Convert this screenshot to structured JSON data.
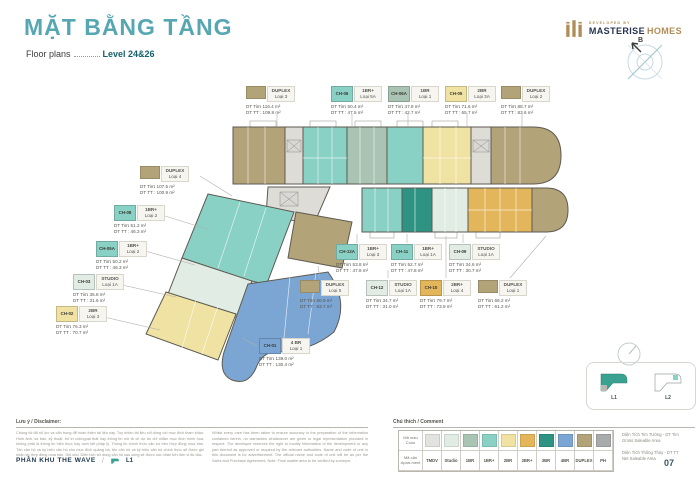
{
  "page": {
    "title_vn": "MẶT BẰNG TẦNG",
    "title_en": "Floor plans",
    "level": "Level 24&26",
    "page_number": "07"
  },
  "brand": {
    "developed_by": "DEVELOPED BY",
    "name_primary": "MASTERISE",
    "name_secondary": "HOMES",
    "compass_label": "B"
  },
  "area_labels": {
    "tim": "DT Tim",
    "tt": "DT TT",
    "unit": "m²"
  },
  "palette": {
    "tmdv": "#e2e2df",
    "studio": "#e0ece4",
    "br1": "#a9c4b2",
    "br1p": "#8ad1c5",
    "br2": "#f0e2a2",
    "br2p": "#e4b65b",
    "br3": "#2f9383",
    "br4": "#7ba6d4",
    "duplex": "#b2a478",
    "ph": "#a8abab"
  },
  "units": [
    {
      "code": "",
      "type": "DUPLEX",
      "variant": "Loại 3",
      "dt_tim": "116.4",
      "dt_tt": "109.8",
      "color": "duplex",
      "x": 246,
      "y": 86
    },
    {
      "code": "CH-06",
      "type": "1BR+",
      "variant": "Loại 5A",
      "dt_tim": "50.4",
      "dt_tt": "47.5",
      "color": "br1p",
      "x": 331,
      "y": 86
    },
    {
      "code": "CH-06A",
      "type": "1BR",
      "variant": "Loại 1",
      "dt_tim": "47.8",
      "dt_tt": "42.7",
      "color": "br1",
      "x": 388,
      "y": 86
    },
    {
      "code": "CH-05",
      "type": "2BR",
      "variant": "Loại 3A",
      "dt_tim": "71.6",
      "dt_tt": "65.7",
      "color": "br2",
      "x": 445,
      "y": 86
    },
    {
      "code": "",
      "type": "DUPLEX",
      "variant": "Loại 2",
      "dt_tim": "88.7",
      "dt_tt": "83.6",
      "color": "duplex",
      "x": 501,
      "y": 86
    },
    {
      "code": "",
      "type": "DUPLEX",
      "variant": "Loại 4",
      "dt_tim": "107.5",
      "dt_tt": "100.9",
      "color": "duplex",
      "x": 140,
      "y": 166
    },
    {
      "code": "CH-08",
      "type": "1BR+",
      "variant": "Loại 2",
      "dt_tim": "51.2",
      "dt_tt": "46.3",
      "color": "br1p",
      "x": 114,
      "y": 205
    },
    {
      "code": "CH-05A",
      "type": "1BR+",
      "variant": "Loại 2",
      "dt_tim": "50.2",
      "dt_tt": "46.3",
      "color": "br1p",
      "x": 96,
      "y": 241
    },
    {
      "code": "CH-03",
      "type": "STUDIO",
      "variant": "Loại 1A",
      "dt_tim": "35.8",
      "dt_tt": "31.6",
      "color": "studio",
      "x": 73,
      "y": 274
    },
    {
      "code": "CH-02",
      "type": "2BR",
      "variant": "Loại 3",
      "dt_tim": "76.3",
      "dt_tt": "70.7",
      "color": "br2",
      "x": 56,
      "y": 306
    },
    {
      "code": "CH-01",
      "type": "4 BR",
      "variant": "Loại 1",
      "dt_tim": "139.0",
      "dt_tt": "130.4",
      "color": "br4",
      "x": 259,
      "y": 338
    },
    {
      "code": "CH-13A",
      "type": "1BR+",
      "variant": "Loại 3",
      "dt_tim": "53.8",
      "dt_tt": "47.8",
      "color": "br1p",
      "x": 336,
      "y": 244
    },
    {
      "code": "CH-11",
      "type": "1BR+",
      "variant": "Loại 1A",
      "dt_tim": "52.7",
      "dt_tt": "47.8",
      "color": "br1p",
      "x": 391,
      "y": 244
    },
    {
      "code": "CH-09",
      "type": "STUDIO",
      "variant": "Loại 1A",
      "dt_tim": "34.6",
      "dt_tt": "30.7",
      "color": "studio",
      "x": 449,
      "y": 244
    },
    {
      "code": "",
      "type": "DUPLEX",
      "variant": "Loại 5",
      "dt_tim": "90.9",
      "dt_tt": "83.7",
      "color": "duplex",
      "x": 300,
      "y": 280
    },
    {
      "code": "CH-12",
      "type": "STUDIO",
      "variant": "Loại 1A",
      "dt_tim": "34.7",
      "dt_tt": "31.0",
      "color": "studio",
      "x": 366,
      "y": 280
    },
    {
      "code": "CH-10",
      "type": "2BR+",
      "variant": "Loại 4",
      "dt_tim": "79.7",
      "dt_tt": "73.9",
      "color": "br2p",
      "x": 420,
      "y": 280
    },
    {
      "code": "",
      "type": "DUPLEX",
      "variant": "Loại 1",
      "dt_tim": "66.2",
      "dt_tt": "61.2",
      "color": "duplex",
      "x": 478,
      "y": 280
    }
  ],
  "legend": {
    "heading": "Chú thích / Comment",
    "color_label_vn": "Mã màu",
    "color_label_en": "Color",
    "unit_label_vn": "Mã căn",
    "unit_label_en": "Apart-ment",
    "items": [
      {
        "label": "TMDV",
        "color": "#e2e2df"
      },
      {
        "label": "Studio",
        "color": "#e0ece4"
      },
      {
        "label": "1BR",
        "color": "#a9c4b2"
      },
      {
        "label": "1BR+",
        "color": "#8ad1c5"
      },
      {
        "label": "2BR",
        "color": "#f0e2a2"
      },
      {
        "label": "2BR+",
        "color": "#e4b65b"
      },
      {
        "label": "3BR",
        "color": "#2f9383"
      },
      {
        "label": "4BR",
        "color": "#7ba6d4"
      },
      {
        "label": "DUPLEX",
        "color": "#b2a478"
      },
      {
        "label": "PH",
        "color": "#a8abab"
      }
    ],
    "notes": [
      {
        "vn": "Diện Tích Tim Tường - DT Tim",
        "en": "Gross Saleable Area"
      },
      {
        "vn": "Diện Tích Thông Thủy - DT TT",
        "en": "Net Saleable Area"
      }
    ]
  },
  "disclaimer": {
    "heading": "Lưu ý / Disclaimer:",
    "vn": "Chúng tôi đã nỗ lực và cẩn trọng để hoàn thiện tài liệu này. Tuy nhiên tài liệu chỉ dùng với mục đích tham khảo. Hình ảnh, sa bàn, kỹ thuật, bố trí nội/ngoại thất hay thông tin mô tả về dự án chỉ nhằm mục đích minh họa, không phải là thông tin hiện thực hay cam kết pháp lý. Thông tin chính thức căn cứ trên Hợp đồng mua bán. Tên căn hộ và ký hiệu căn hộ cho mục đích quảng bá, tên căn hộ và ký hiệu căn hộ chính thức sẽ được ghi nhận tại Hợp đồng mua bán. Ghi chú: Diện tích sử dụng căn hộ sau cùng sẽ được xác nhận bởi đơn vị đo đạc.",
    "en": "Whilst every care has been taken to ensure accuracy in the preparation of the information contained herein, no warranties whatsoever are given or legal representation provided in respect. The developer reserves the right to modify information of the development or any part thereof as approved or required by the relevant authorities. Name and code of unit in this document is for advertisement. The official name and code of unit will be as per the Sales and Purchase Agreement. Note: Final usable area to be verified by surveyor."
  },
  "footer": {
    "zone": "PHÂN KHU THE WAVE",
    "separator": "/",
    "marker": "L1"
  },
  "keymap": {
    "items": [
      {
        "label": "L1"
      },
      {
        "label": "L2"
      }
    ]
  }
}
